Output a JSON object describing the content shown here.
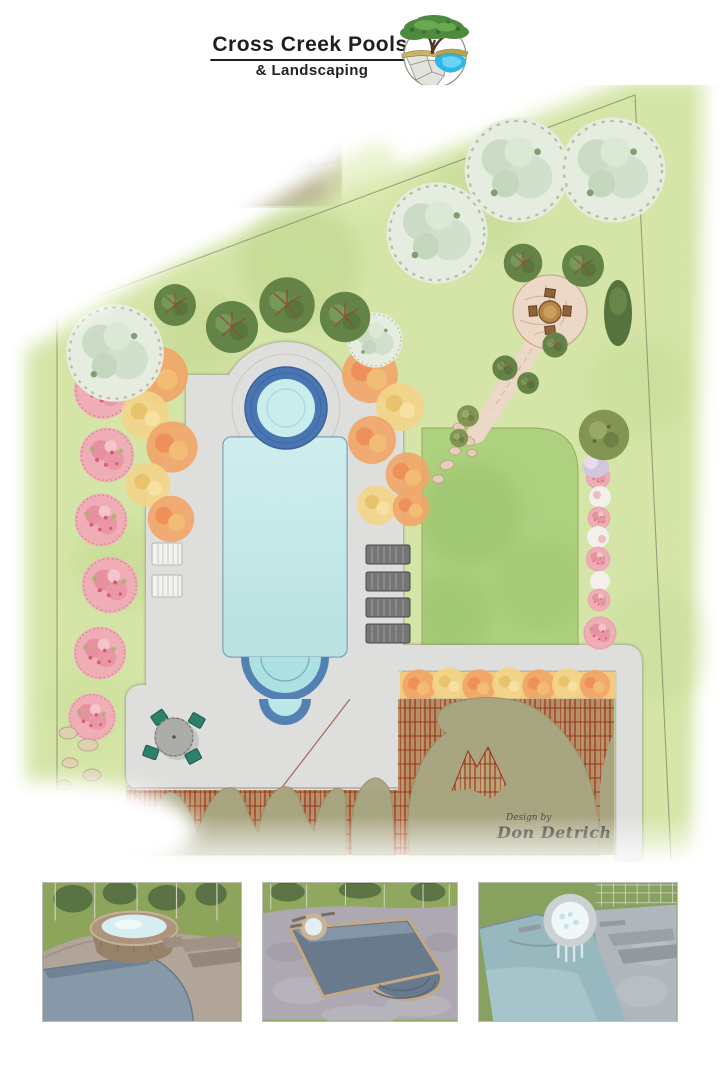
{
  "header": {
    "title": "Cross Creek Pools",
    "subtitle": "& Landscaping",
    "logo_icon": "oak-tree-pond-flagstone-logo"
  },
  "hero_photo": {
    "icon": "raised-round-spa-photo"
  },
  "plan": {
    "credit_prefix": "Design by",
    "credit_name": "Don Detrich",
    "features": [
      "spa",
      "swimming-pool",
      "concrete-deck",
      "wood-deck",
      "tree-canopy",
      "lawn",
      "flagstone-patio",
      "flagstone-path",
      "pink-flowering-trees",
      "sage-trees",
      "maple-trees",
      "orange-yellow-shrubs",
      "lounge-chairs",
      "dining-set",
      "patio-set",
      "boulders",
      "property-lines"
    ]
  },
  "renders": [
    {
      "icon": "render-spa-corner-view"
    },
    {
      "icon": "render-pool-length-view"
    },
    {
      "icon": "render-spa-filled-view"
    }
  ],
  "colors": {
    "lawn_light": "#cfe39c",
    "lawn_dark": "#a9cf78",
    "deck_concrete": "#dcdcd7",
    "pool_water": "#a5dcdb",
    "spa_ring": "#3f6fae",
    "wood_deck_red": "#a03a1c",
    "wood_deck_khaki": "#b49f6e",
    "tree_canopy_olive": "#a3a27b",
    "flower_pink": "#efa9b2",
    "shrub_orange": "#f0a25f",
    "shrub_yellow": "#f2d383",
    "tree_sage": "#e3ecdf",
    "tree_green": "#5c7d3d",
    "logo_pond_blue": "#2bb7ea",
    "title_text": "#1f1f1f",
    "signature_text": "#2e2e24"
  }
}
